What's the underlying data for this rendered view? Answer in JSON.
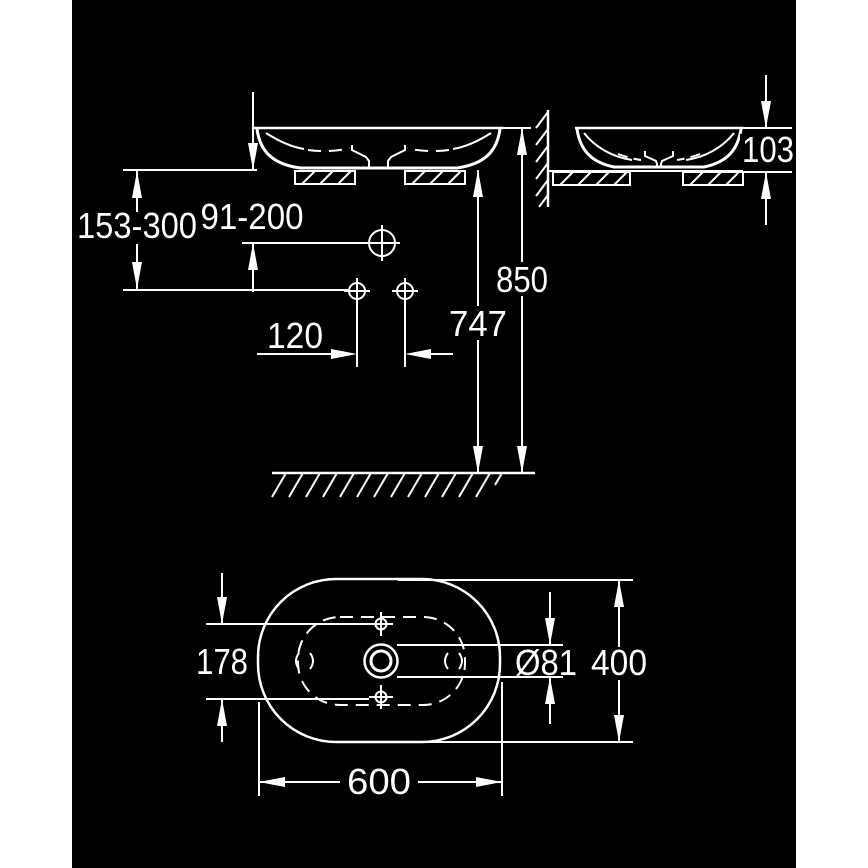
{
  "drawing": {
    "type": "technical-installation-drawing",
    "subject": "oval countertop vessel washbasin, side elevation and plan view",
    "colors": {
      "page": "#ffffff",
      "canvas": "#000000",
      "line": "#ffffff"
    },
    "dimension_labels": {
      "counter_to_supply": "153-300",
      "counter_to_faucet": "91-200",
      "supply_spacing": "120",
      "floor_to_underside": "747",
      "floor_to_rim": "850",
      "basin_height": "103",
      "hole_span": "178",
      "drain_diameter": "Ø81",
      "basin_depth": "400",
      "basin_width": "600"
    }
  }
}
